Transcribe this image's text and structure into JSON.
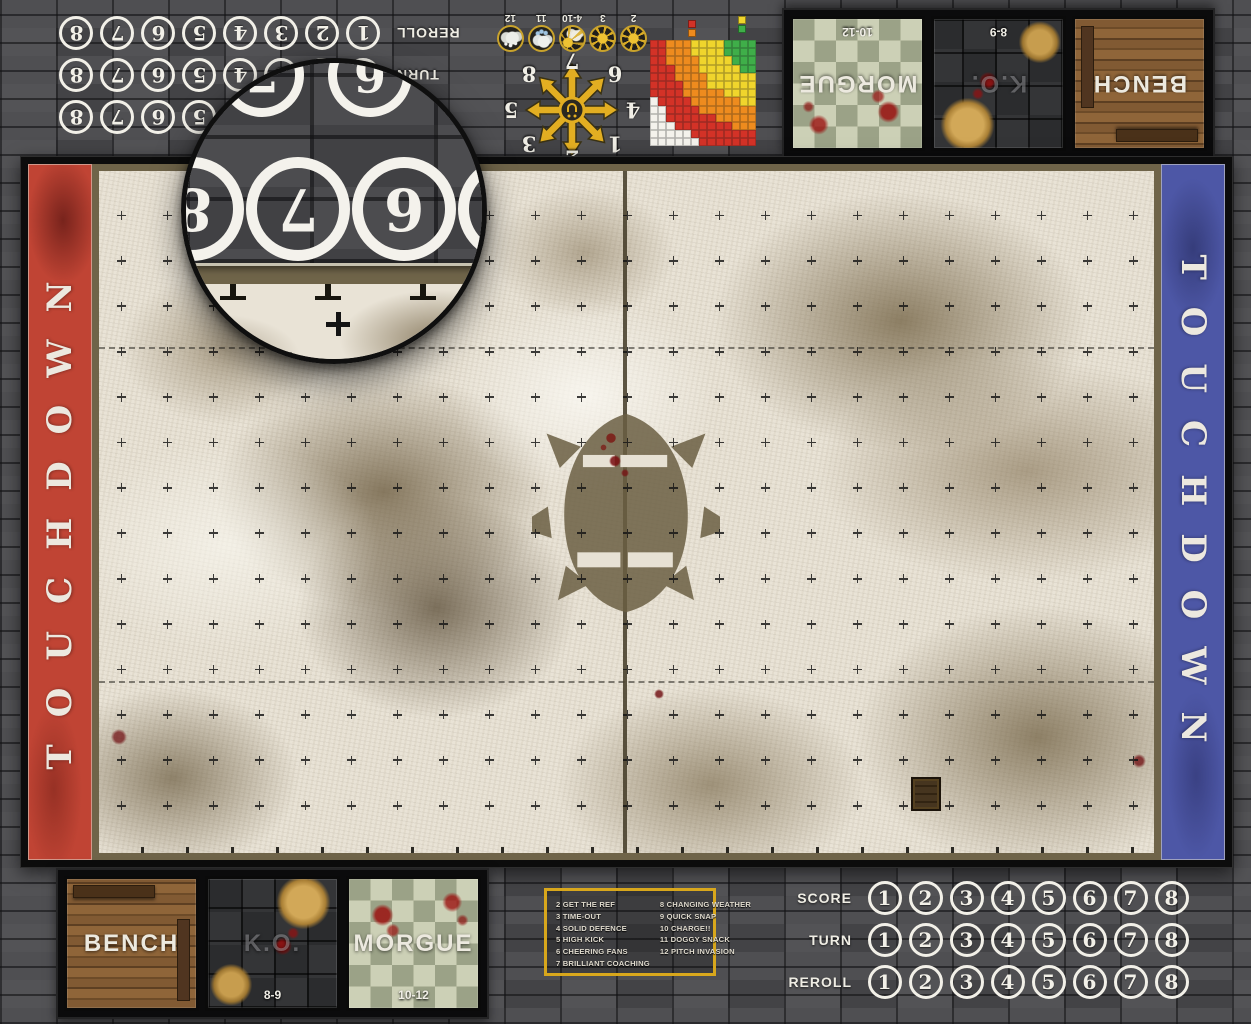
{
  "banners": {
    "left": {
      "text": "TOUCHDOWN",
      "color": "#c04434"
    },
    "right": {
      "text": "TOUCHDOWN",
      "color": "#4d57a6"
    }
  },
  "tracks": {
    "rows": [
      "SCORE",
      "TURN",
      "REROLL"
    ],
    "numbers": [
      "1",
      "2",
      "3",
      "4",
      "5",
      "6",
      "7",
      "8"
    ]
  },
  "dugout": {
    "boxes": [
      {
        "label": "BENCH",
        "range": "",
        "style": "wood"
      },
      {
        "label": "K.O.",
        "range": "8-9",
        "style": "stone"
      },
      {
        "label": "MORGUE",
        "range": "10-12",
        "style": "checker"
      }
    ]
  },
  "weather": {
    "entries": [
      {
        "range": "2",
        "icon": "sun"
      },
      {
        "range": "3",
        "icon": "sun"
      },
      {
        "range": "4-10",
        "icon": "sun-cloud"
      },
      {
        "range": "11",
        "icon": "rain-cloud"
      },
      {
        "range": "12",
        "icon": "snow-cloud"
      }
    ]
  },
  "scatter": {
    "numbers": [
      "1",
      "2",
      "3",
      "4",
      "5",
      "6",
      "7",
      "8"
    ]
  },
  "range_ruler": {
    "rows": [
      "RROOOYYYYGGGG",
      "RROOOYYYYGGGG",
      "RROOOOYYYYGGG",
      "RRROOOYYYYYGG",
      "RRROOOOYYYYYY",
      "RRRROOOYYYYYY",
      "RRRROOOOOYYYY",
      "WRRRROOOOOOYY",
      "WWRRRROOOOOOO",
      "WWRRRRRROOOOO",
      "WWWRRRRRRROOO",
      "WWWWWRRRRRRRR",
      "WWWWWWRRRRRRR"
    ],
    "colors": {
      "G": "#3fae49",
      "Y": "#f0d52c",
      "O": "#ee8b1e",
      "R": "#d33227",
      "W": "#f4f2ec"
    },
    "legend": [
      "R",
      "O",
      "Y",
      "G"
    ]
  },
  "kickoff": {
    "left_column": [
      "2 GET THE REF",
      "3 TIME-OUT",
      "4 SOLID DEFENCE",
      "5 HIGH KICK",
      "6 CHEERING FANS",
      "7 BRILLIANT COACHING"
    ],
    "right_column": [
      "8 CHANGING WEATHER",
      "9 QUICK SNAP",
      "10 CHARGE!!",
      "11 DOGGY SNACK",
      "12 PITCH INVASION"
    ]
  },
  "magnifier": {
    "numbers_top": [
      "7",
      "6"
    ],
    "numbers_main": [
      "8",
      "7",
      "6",
      "5"
    ]
  }
}
